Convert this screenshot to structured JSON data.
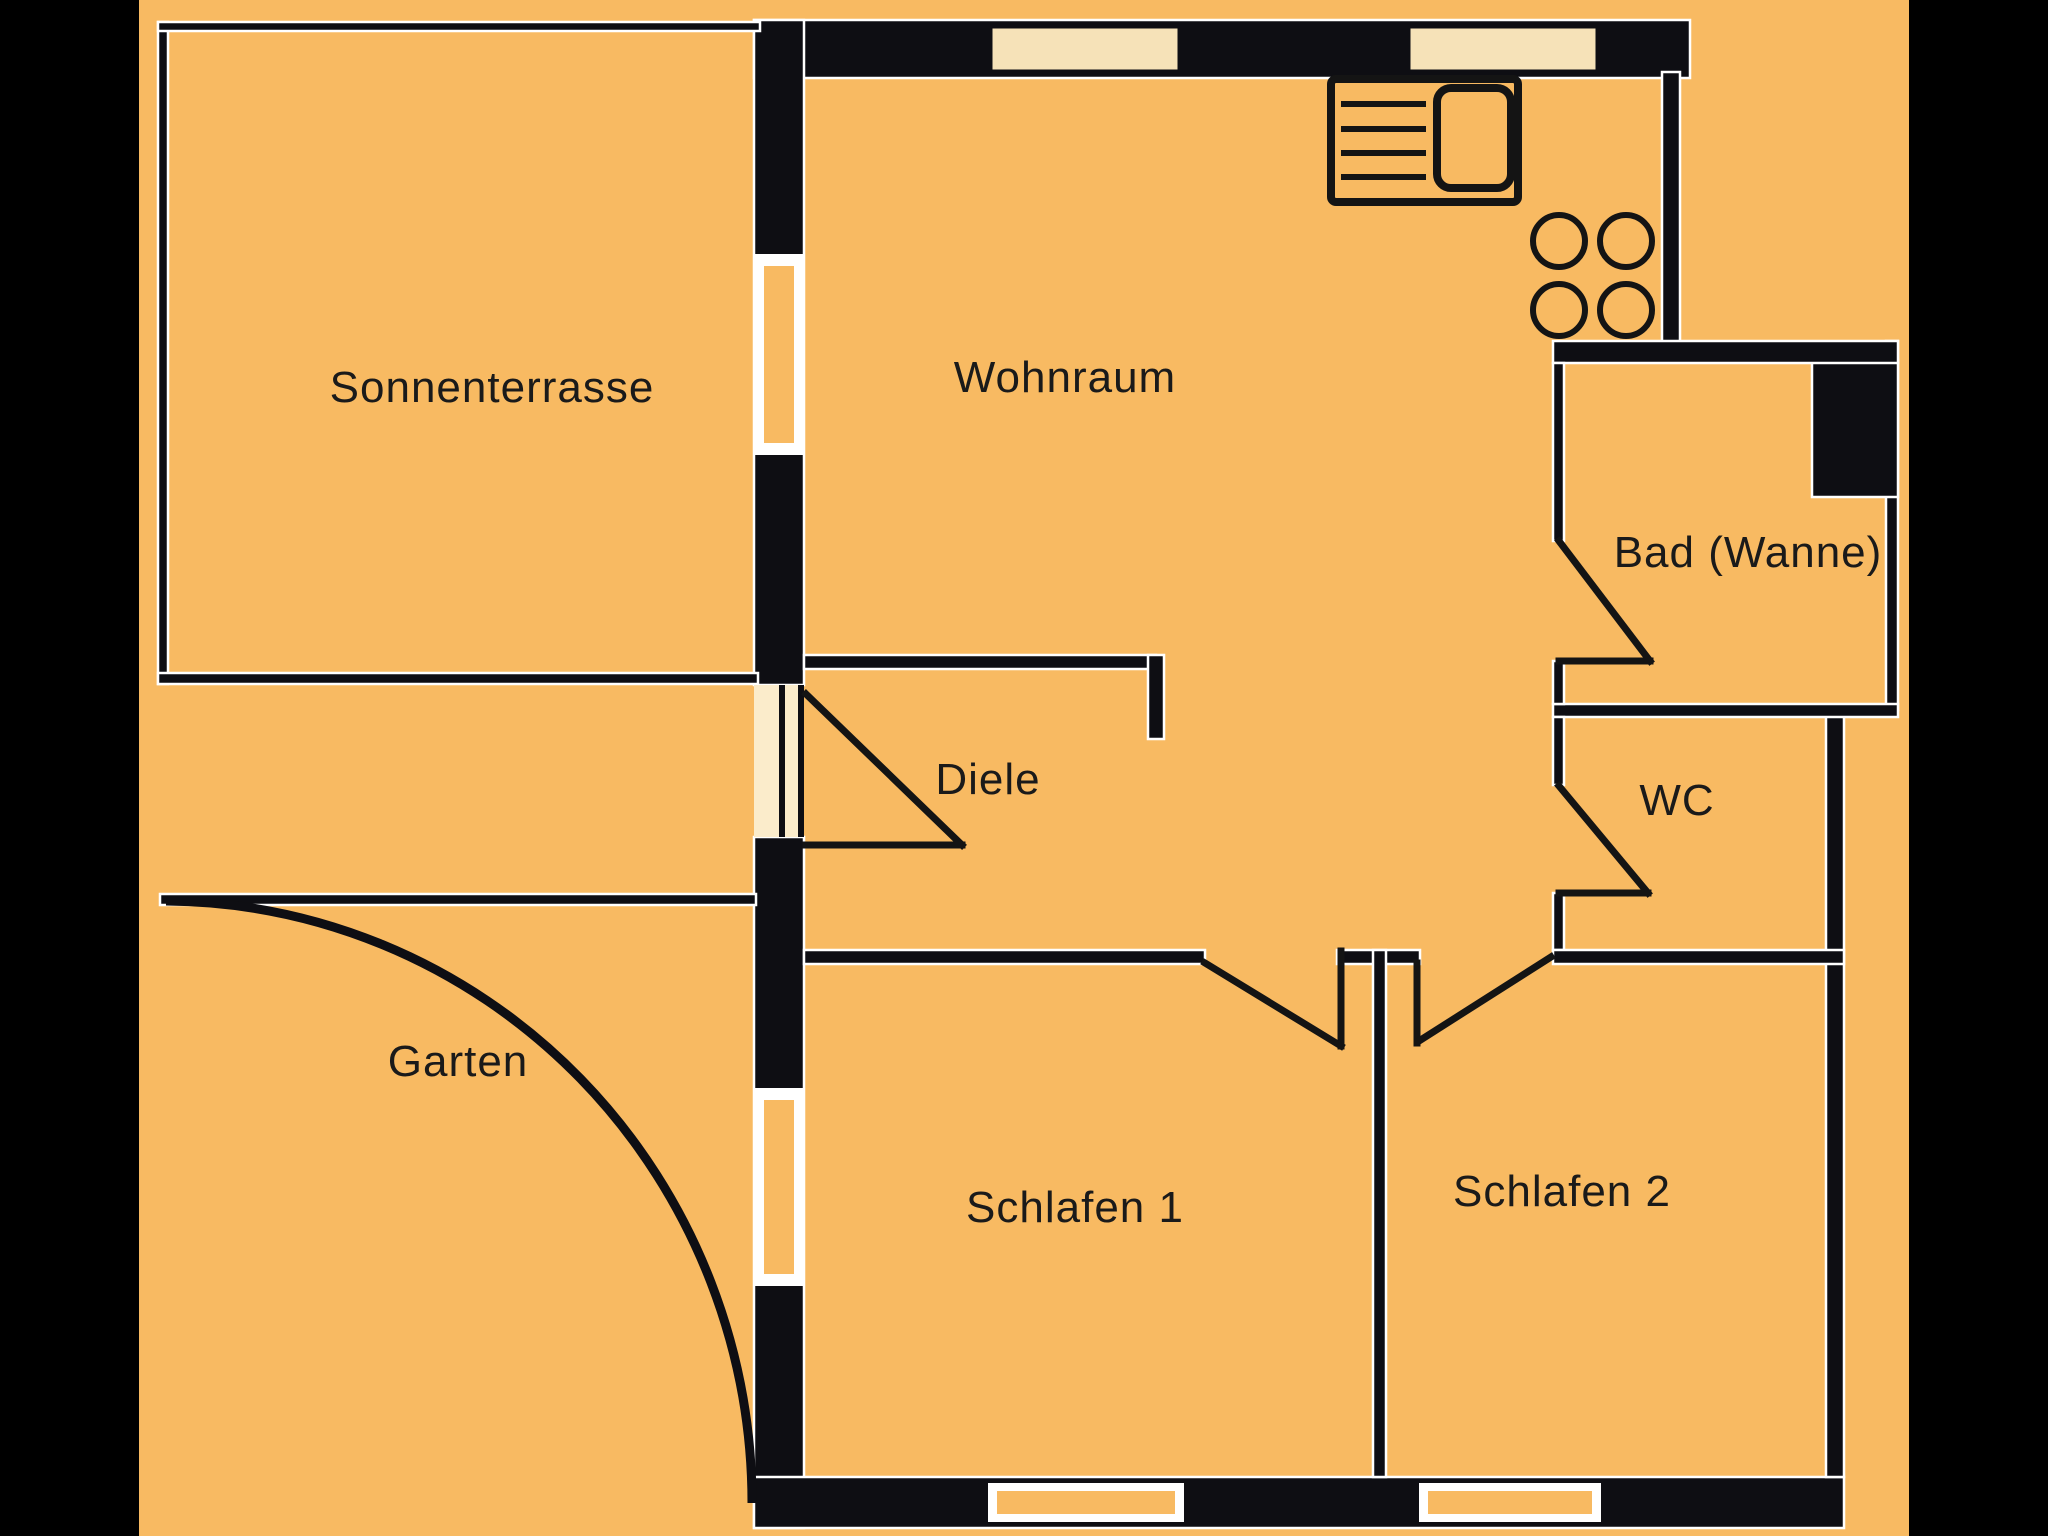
{
  "palette": {
    "background_bars": "#000000",
    "floor_field": "#f8ba62",
    "walls": "#0e0e13",
    "window_light_fill": "#f6e2b8",
    "window_frame": "#ffffff",
    "label_text": "#1a1a1a"
  },
  "rooms": [
    {
      "id": "sonnenterrasse",
      "label": "Sonnenterrasse"
    },
    {
      "id": "wohnraum",
      "label": "Wohnraum"
    },
    {
      "id": "bad",
      "label": "Bad (Wanne)"
    },
    {
      "id": "diele",
      "label": "Diele"
    },
    {
      "id": "wc",
      "label": "WC"
    },
    {
      "id": "garten",
      "label": "Garten"
    },
    {
      "id": "schlafen1",
      "label": "Schlafen 1"
    },
    {
      "id": "schlafen2",
      "label": "Schlafen 2"
    }
  ],
  "fixtures": [
    {
      "icon": "kitchen-sink-icon",
      "location": "wohnraum kitchen corner, top wall"
    },
    {
      "icon": "stove-burners-icon",
      "location": "wohnraum kitchen corner, right wall",
      "burners": 4
    },
    {
      "icon": "garden-arc-boundary",
      "location": "garten, quarter-circle edge"
    }
  ],
  "doors": [
    {
      "id": "door-diele-entry",
      "between": "corridor / Diele"
    },
    {
      "id": "door-bad",
      "between": "Wohnraum / Bad (Wanne)"
    },
    {
      "id": "door-wc",
      "between": "Diele / WC"
    },
    {
      "id": "door-schlafen1",
      "between": "Diele / Schlafen 1"
    },
    {
      "id": "door-schlafen2",
      "between": "Diele / Schlafen 2"
    }
  ],
  "windows": [
    {
      "id": "window-top-1",
      "wall": "top, Wohnraum"
    },
    {
      "id": "window-top-2",
      "wall": "top, kitchen corner"
    },
    {
      "id": "window-left-1",
      "wall": "left, Wohnraum"
    },
    {
      "id": "window-left-2",
      "wall": "left, Schlafen 1"
    },
    {
      "id": "window-bottom-1",
      "wall": "bottom, Schlafen 1"
    },
    {
      "id": "window-bottom-2",
      "wall": "bottom, Schlafen 2"
    }
  ]
}
